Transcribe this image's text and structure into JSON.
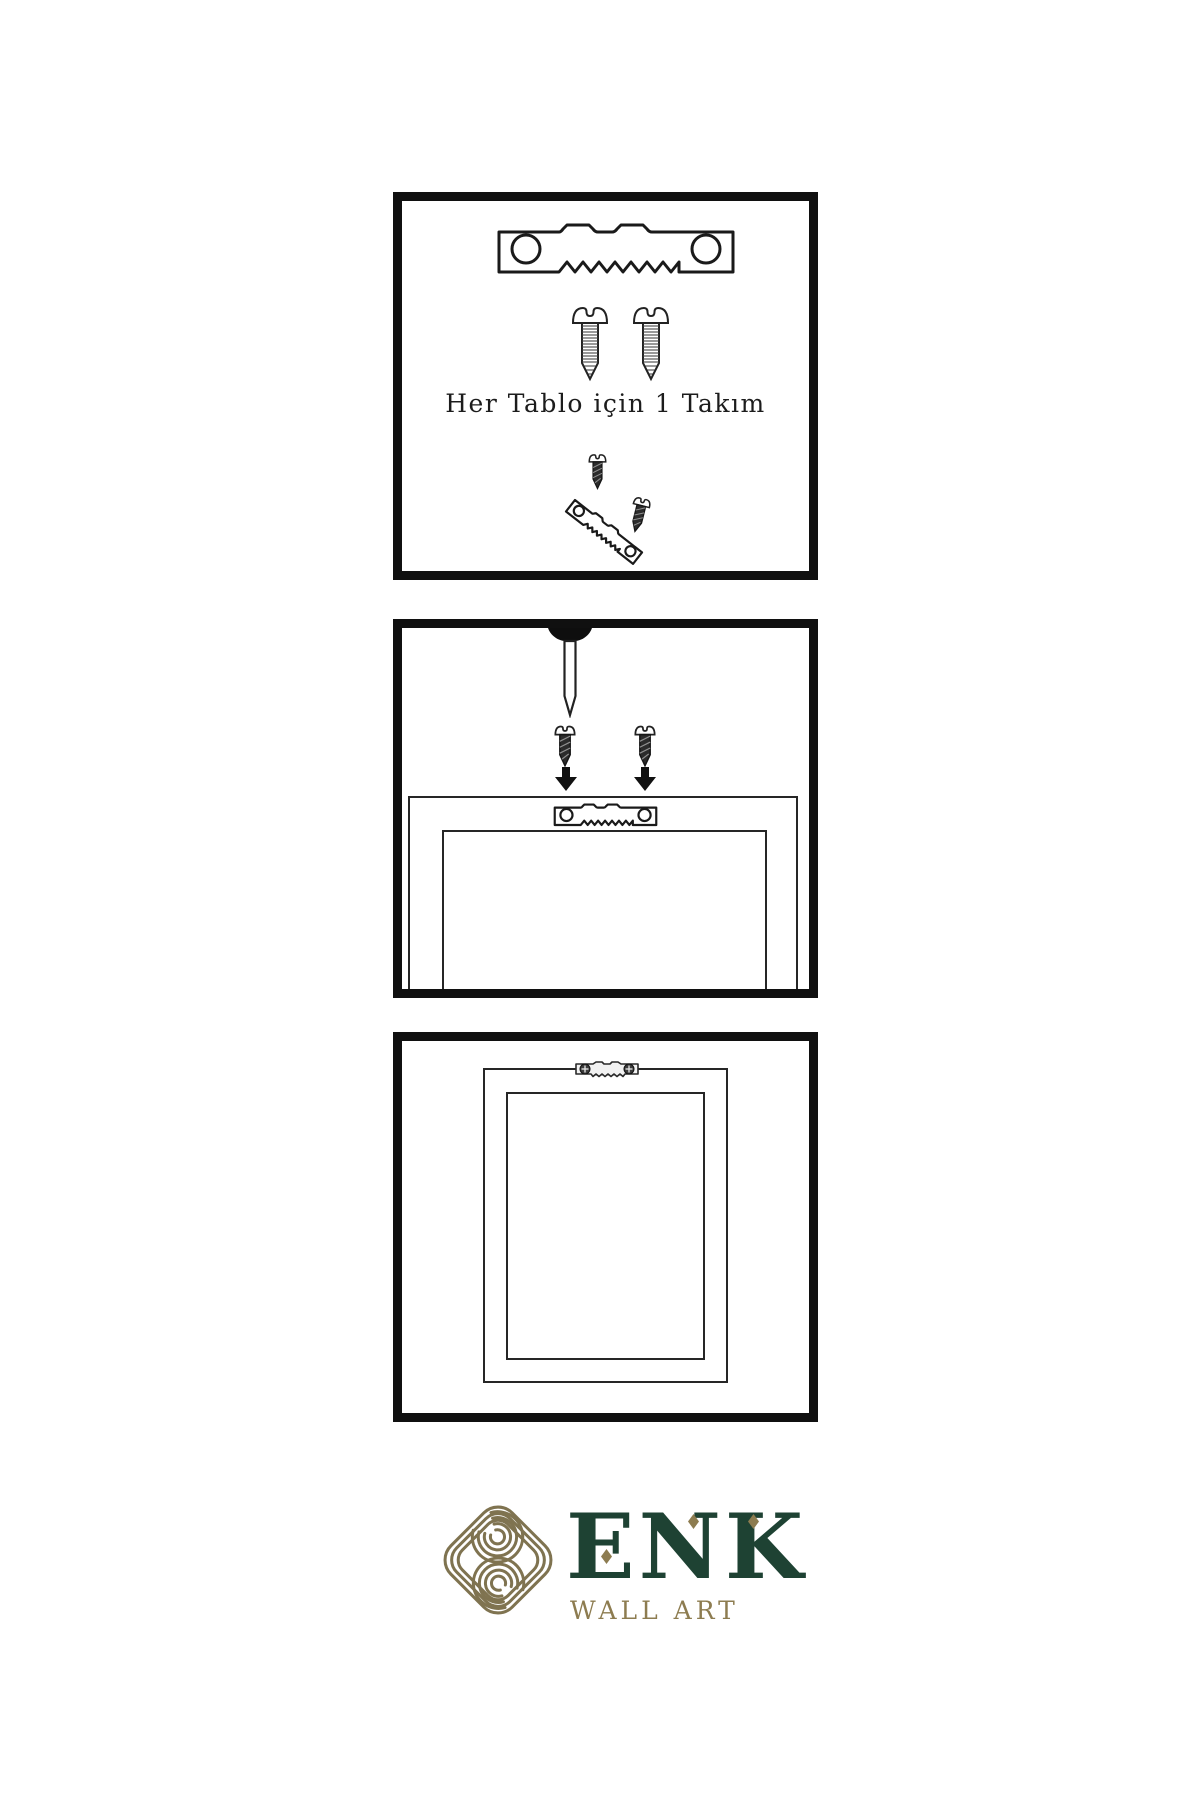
{
  "page": {
    "background": "#ffffff"
  },
  "instructions": {
    "panel1": {
      "caption": "Her Tablo için 1 Takım",
      "icons": [
        "sawtooth-hanger-icon",
        "screw-icon",
        "screw-icon",
        "dark-screw-icon",
        "angled-sawtooth-hanger-icon",
        "dark-screw-icon"
      ]
    },
    "panel2": {
      "icons": [
        "nail-icon",
        "dark-screw-icon",
        "dark-screw-icon",
        "down-arrow-icon",
        "down-arrow-icon",
        "sawtooth-hanger-icon",
        "frame-back-outline"
      ]
    },
    "panel3": {
      "icons": [
        "mounted-sawtooth-hanger-icon",
        "hung-frame-outline"
      ]
    }
  },
  "brand": {
    "name": "ENK",
    "subtitle": "WALL ART",
    "logo_icon": "knot-icon",
    "colors": {
      "green": "#1e4233",
      "gold_icon": "#7f7350",
      "gold_text": "#8d7c50",
      "line": "#101010"
    }
  }
}
